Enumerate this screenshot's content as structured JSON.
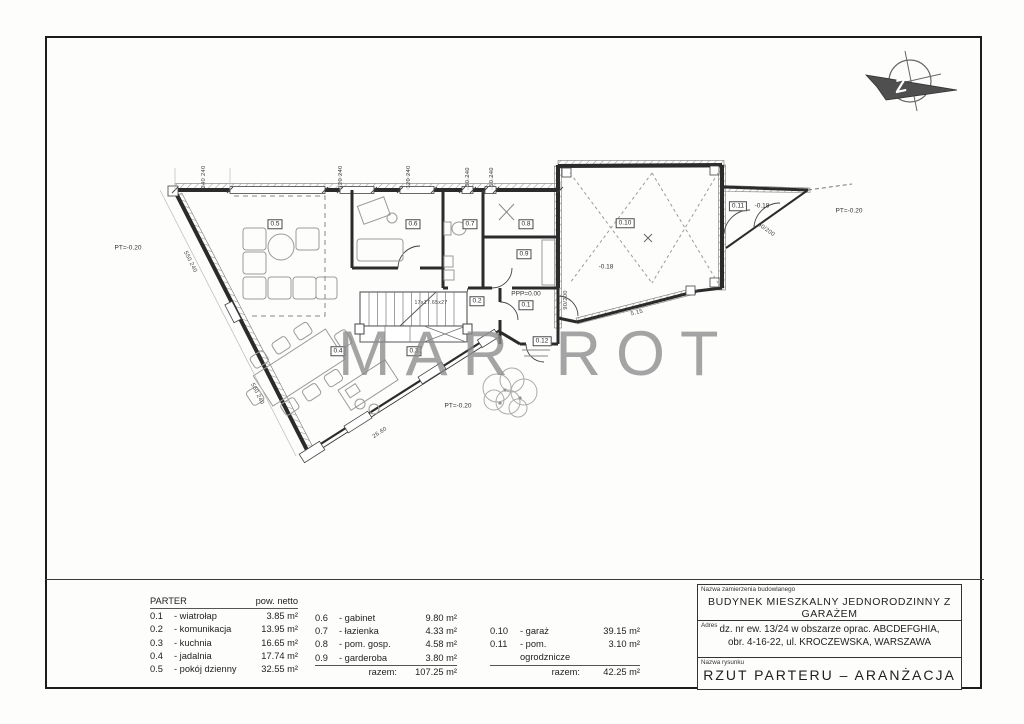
{
  "watermark": {
    "text": "MAR ROT"
  },
  "north_arrow": {
    "letter": "Z"
  },
  "plan": {
    "room_labels": [
      "0.1",
      "0.2",
      "0.3",
      "0.4",
      "0.5",
      "0.6",
      "0.7",
      "0.8",
      "0.9",
      "0.10",
      "0.11",
      "0.12"
    ],
    "levels": {
      "ppp": "PPP=0.00",
      "pt": "PT=-0.20",
      "minus018": "-0.18"
    },
    "dims": {
      "top": [
        "240 240",
        "120 240",
        "120 240",
        "50 240",
        "50 240"
      ],
      "wall_left": "550 240",
      "terrace": "26.60",
      "garage_wall": "5.15",
      "door": "90/200",
      "stairs": "17x17.65x27"
    }
  },
  "legend": {
    "title": "PARTER",
    "area_header": "pow. netto",
    "col1": [
      {
        "no": "0.1",
        "name": "- wiatrołap",
        "area": "3.85 m²"
      },
      {
        "no": "0.2",
        "name": "- komunikacja",
        "area": "13.95 m²"
      },
      {
        "no": "0.3",
        "name": "- kuchnia",
        "area": "16.65 m²"
      },
      {
        "no": "0.4",
        "name": "- jadalnia",
        "area": "17.74 m²"
      },
      {
        "no": "0.5",
        "name": "- pokój dzienny",
        "area": "32.55 m²"
      }
    ],
    "col2": [
      {
        "no": "0.6",
        "name": "- gabinet",
        "area": "9.80 m²"
      },
      {
        "no": "0.7",
        "name": "- łazienka",
        "area": "4.33 m²"
      },
      {
        "no": "0.8",
        "name": "- pom. gosp.",
        "area": "4.58 m²"
      },
      {
        "no": "0.9",
        "name": "- garderoba",
        "area": "3.80 m²"
      }
    ],
    "col2_total_label": "razem:",
    "col2_total": "107.25 m²",
    "col3": [
      {
        "no": "0.10",
        "name": "- garaż",
        "area": "39.15 m²"
      },
      {
        "no": "0.11",
        "name": "- pom. ogrodznicze",
        "area": "3.10 m²"
      }
    ],
    "col3_total_label": "razem:",
    "col3_total": "42.25 m²"
  },
  "title_block": {
    "label1": "Nazwa zamierzenia budowlanego",
    "line1": "BUDYNEK MIESZKALNY JEDNORODZINNY Z GARAŻEM",
    "label2": "Adres",
    "line2a": "dz. nr ew. 13/24 w obszarze oprac. ABCDEFGHIA,",
    "line2b": "obr. 4-16-22, ul. KROCZEWSKA, WARSZAWA",
    "label3": "Nazwa rysunku",
    "line3": "RZUT PARTERU – ARANŻACJA"
  }
}
